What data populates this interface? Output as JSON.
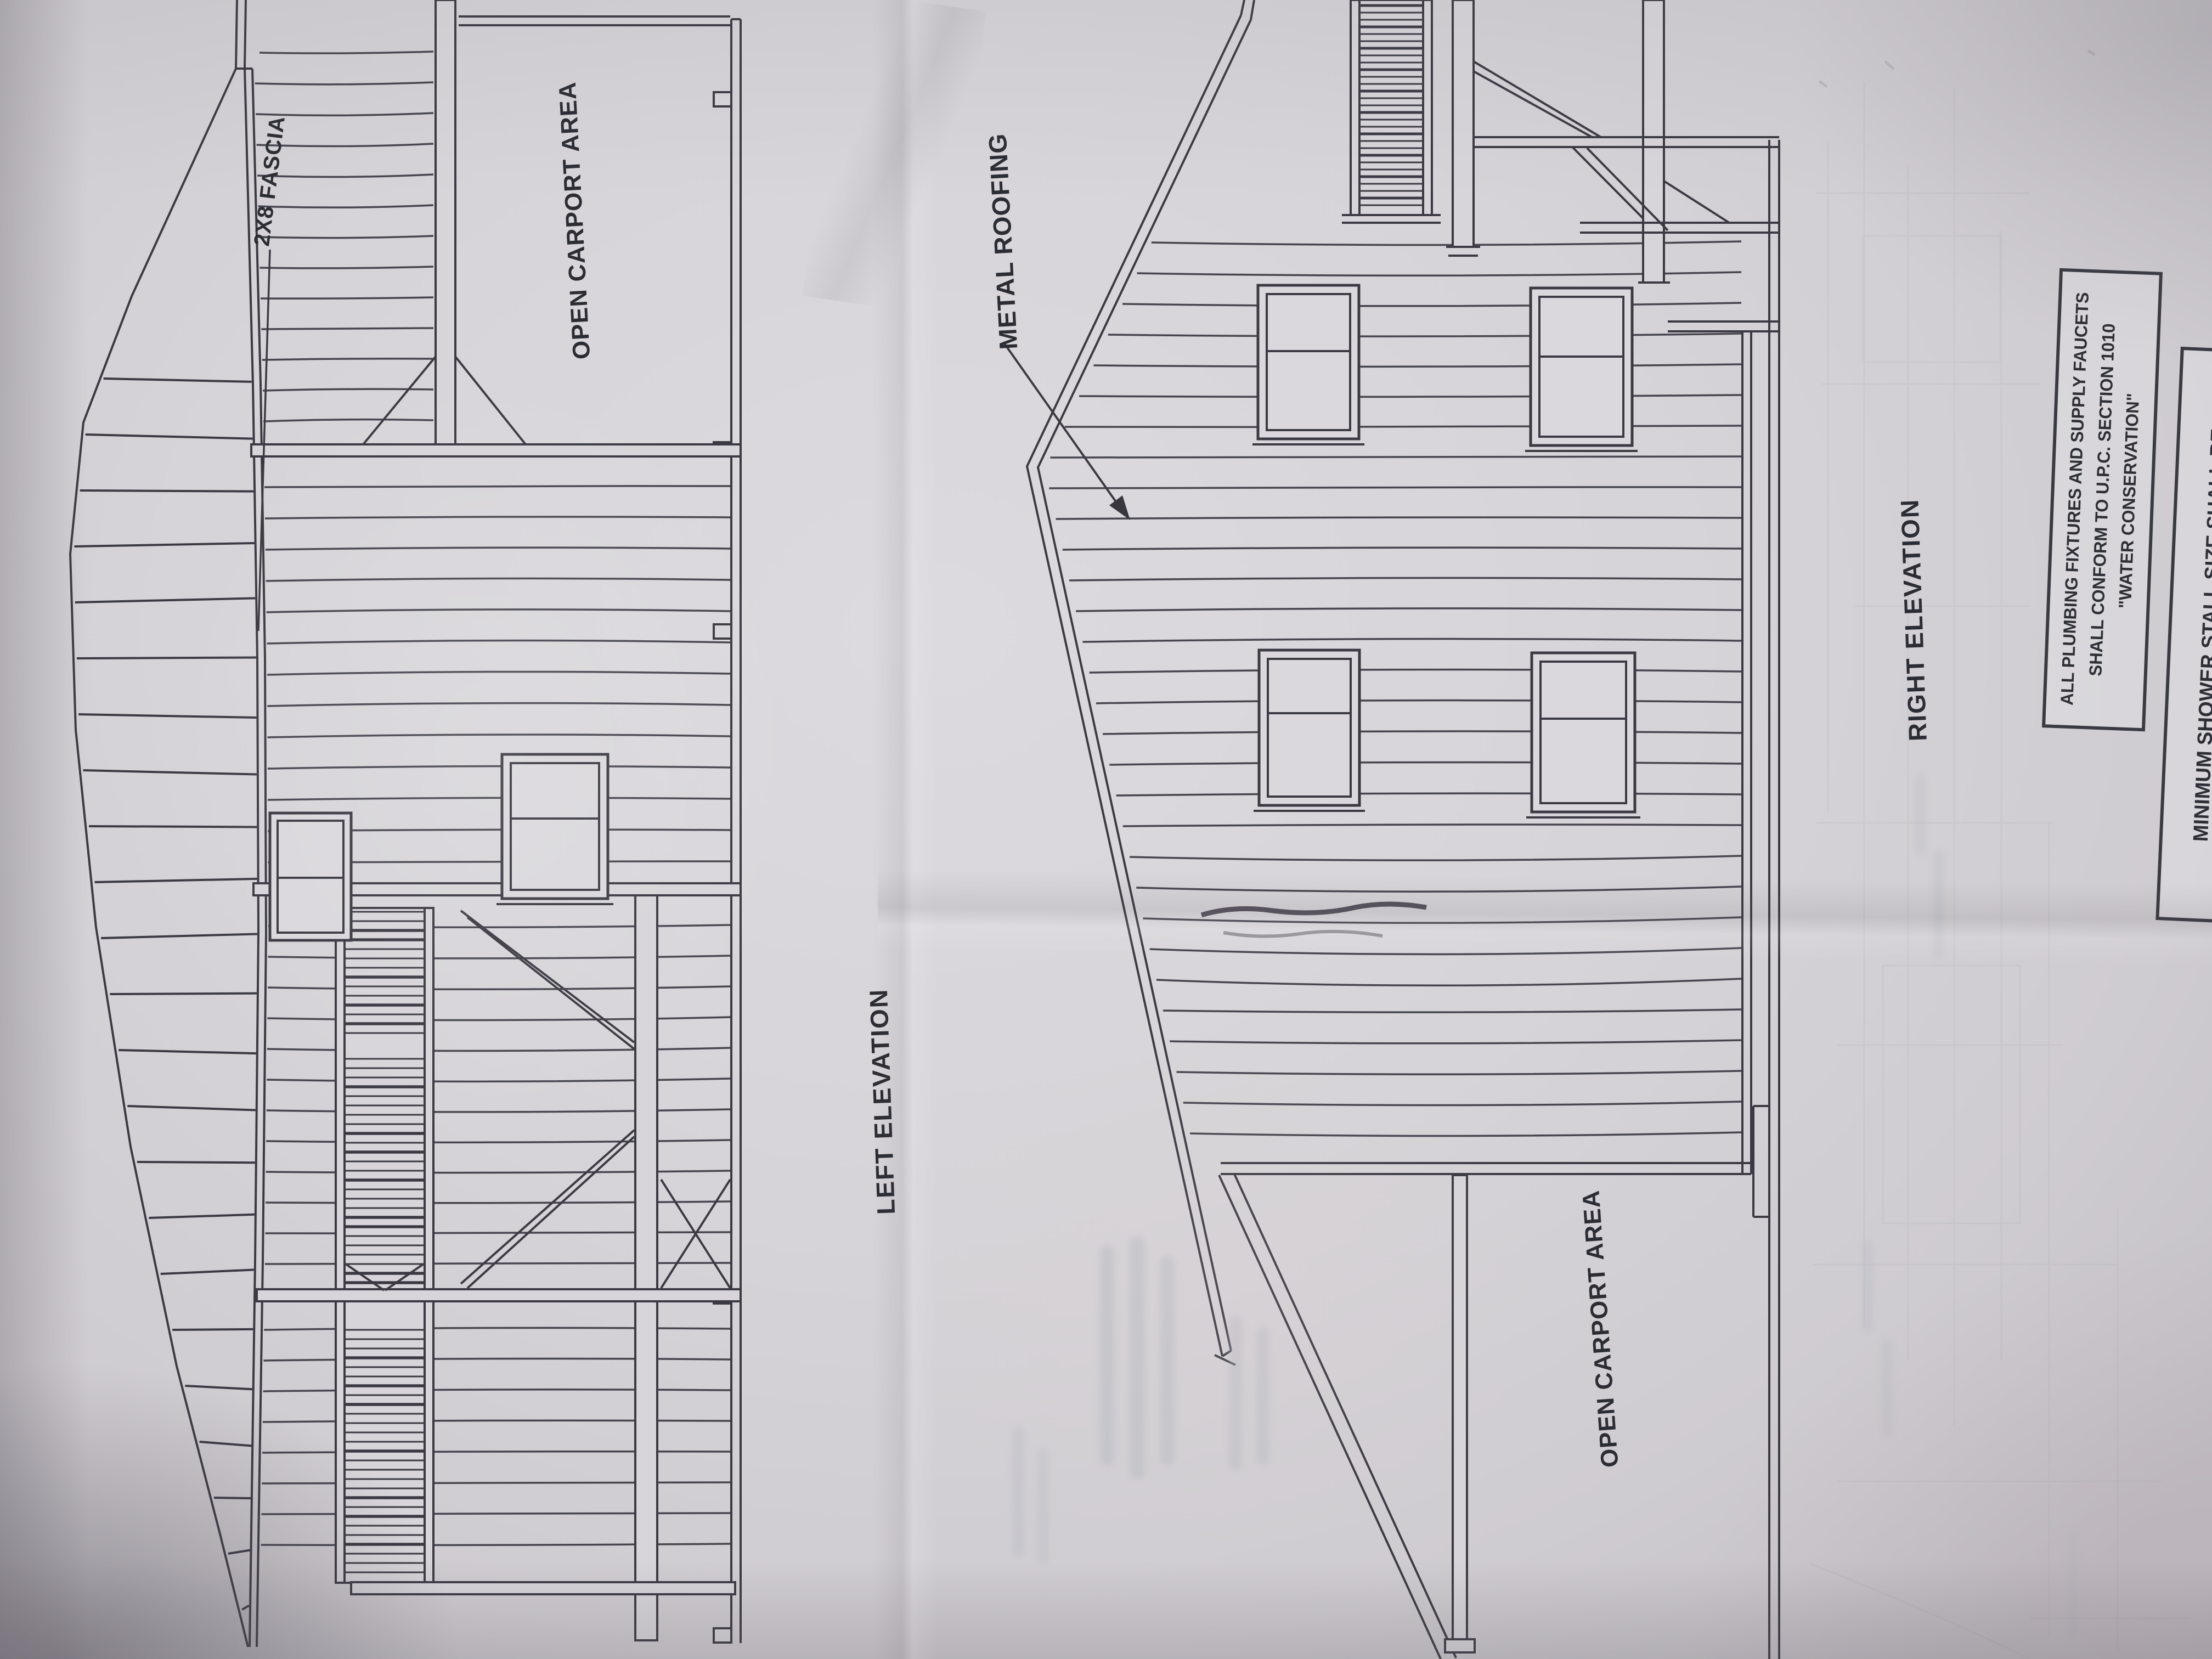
{
  "drawing": {
    "left_elevation": {
      "title": "LEFT ELEVATION",
      "labels": {
        "fascia": "2X8 FASCIA",
        "carport": "OPEN CARPORT AREA"
      }
    },
    "right_elevation": {
      "title": "RIGHT ELEVATION",
      "labels": {
        "roofing": "METAL ROOFING",
        "carport": "OPEN CARPORT AREA"
      }
    },
    "notes": {
      "plumbing_box": {
        "lines": [
          "ALL PLUMBING FIXTURES AND SUPPLY FAUCETS",
          "SHALL CONFORM TO U.P.C. SECTION 1010",
          "\"WATER CONSERVATION\""
        ]
      },
      "shower_box": {
        "lines": [
          "MINIMUM SHOWER STALL SIZE SHALL BE",
          "1024 SQUARE INCHES AND SHALL BE CAPABLE"
        ]
      }
    },
    "colors": {
      "ink": "#38373f",
      "paper": "#d6d4d8",
      "ghost": "#9aa0ae"
    }
  }
}
